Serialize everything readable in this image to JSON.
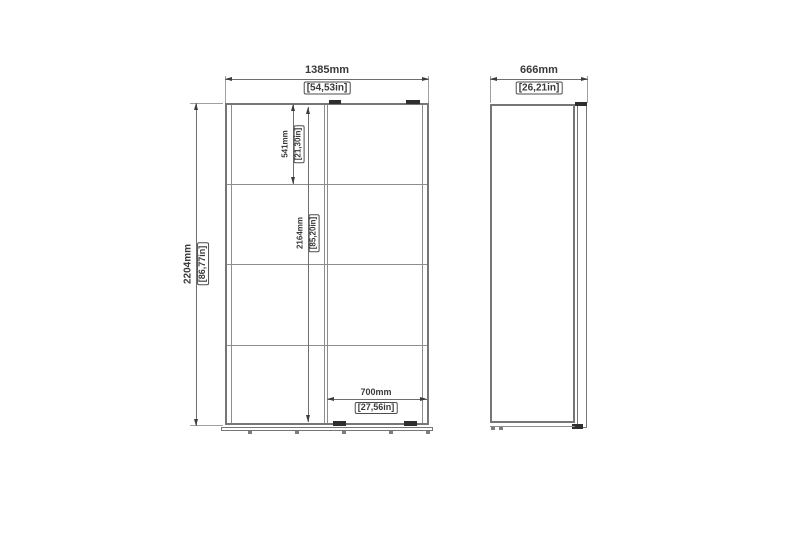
{
  "front_view": {
    "width_mm": "1385mm",
    "width_in": "[54,53in]",
    "height_mm": "2204mm",
    "height_in": "[86,77in]",
    "top_section_mm": "541mm",
    "top_section_in": "[21,30in]",
    "interior_height_mm": "2164mm",
    "interior_height_in": "[85,20in]",
    "door_width_mm": "700mm",
    "door_width_in": "[27,56in]"
  },
  "side_view": {
    "depth_mm": "666mm",
    "depth_in": "[26,21in]"
  },
  "colors": {
    "background": "#ffffff",
    "outline": "#767676",
    "thin_line": "#8d8d8d",
    "dimension_line": "#6e6e6e",
    "text": "#3a3a3a",
    "hardware_black": "#2e2e2e"
  }
}
